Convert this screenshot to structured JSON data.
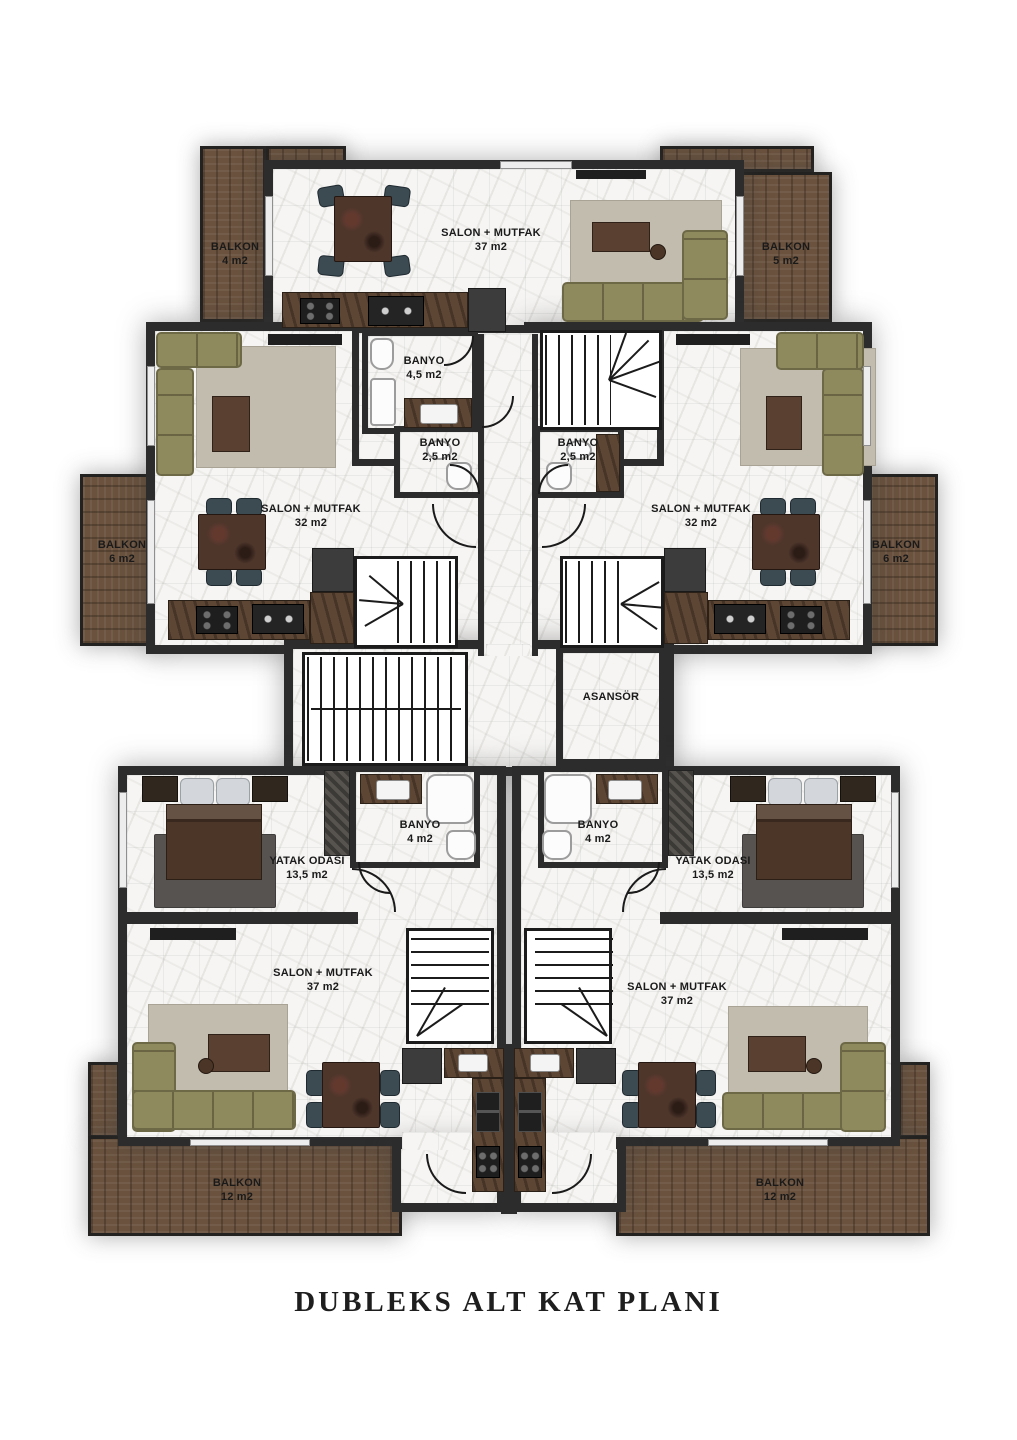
{
  "title": "DUBLEKS ALT KAT PLANI",
  "colors": {
    "wall": "#2c2c2c",
    "floor": "#f6f5f3",
    "balcony_wood": "#6a523e",
    "sofa": "#8f8a5e",
    "carpet": "#c1bcad",
    "dining_table": "#4e362b",
    "chair": "#3c4a52",
    "kitchen_counter": "#5e4634",
    "bed": "#4c3627",
    "bedroom_rug": "#565350",
    "fixture": "#fcfcfc",
    "label_text": "#1a1a1a"
  },
  "rooms": {
    "balkon_top_left": {
      "name": "BALKON",
      "area": "4 m2"
    },
    "salon_top": {
      "name": "SALON + MUTFAK",
      "area": "37 m2"
    },
    "balkon_top_right": {
      "name": "BALKON",
      "area": "5 m2"
    },
    "banyo_top": {
      "name": "BANYO",
      "area": "4,5 m2"
    },
    "banyo_mid_left": {
      "name": "BANYO",
      "area": "2,5 m2"
    },
    "banyo_mid_right": {
      "name": "BANYO",
      "area": "2,5 m2"
    },
    "balkon_mid_left": {
      "name": "BALKON",
      "area": "6 m2"
    },
    "salon_mid_left": {
      "name": "SALON + MUTFAK",
      "area": "32 m2"
    },
    "salon_mid_right": {
      "name": "SALON + MUTFAK",
      "area": "32 m2"
    },
    "balkon_mid_right": {
      "name": "BALKON",
      "area": "6 m2"
    },
    "asansor": {
      "name": "ASANSÖR"
    },
    "yatak_left": {
      "name": "YATAK ODASI",
      "area": "13,5 m2"
    },
    "banyo_bottom_left": {
      "name": "BANYO",
      "area": "4 m2"
    },
    "banyo_bottom_right": {
      "name": "BANYO",
      "area": "4 m2"
    },
    "yatak_right": {
      "name": "YATAK ODASI",
      "area": "13,5 m2"
    },
    "salon_bottom_left": {
      "name": "SALON + MUTFAK",
      "area": "37 m2"
    },
    "salon_bottom_right": {
      "name": "SALON + MUTFAK",
      "area": "37 m2"
    },
    "balkon_bottom_left": {
      "name": "BALKON",
      "area": "12 m2"
    },
    "balkon_bottom_right": {
      "name": "BALKON",
      "area": "12 m2"
    }
  }
}
